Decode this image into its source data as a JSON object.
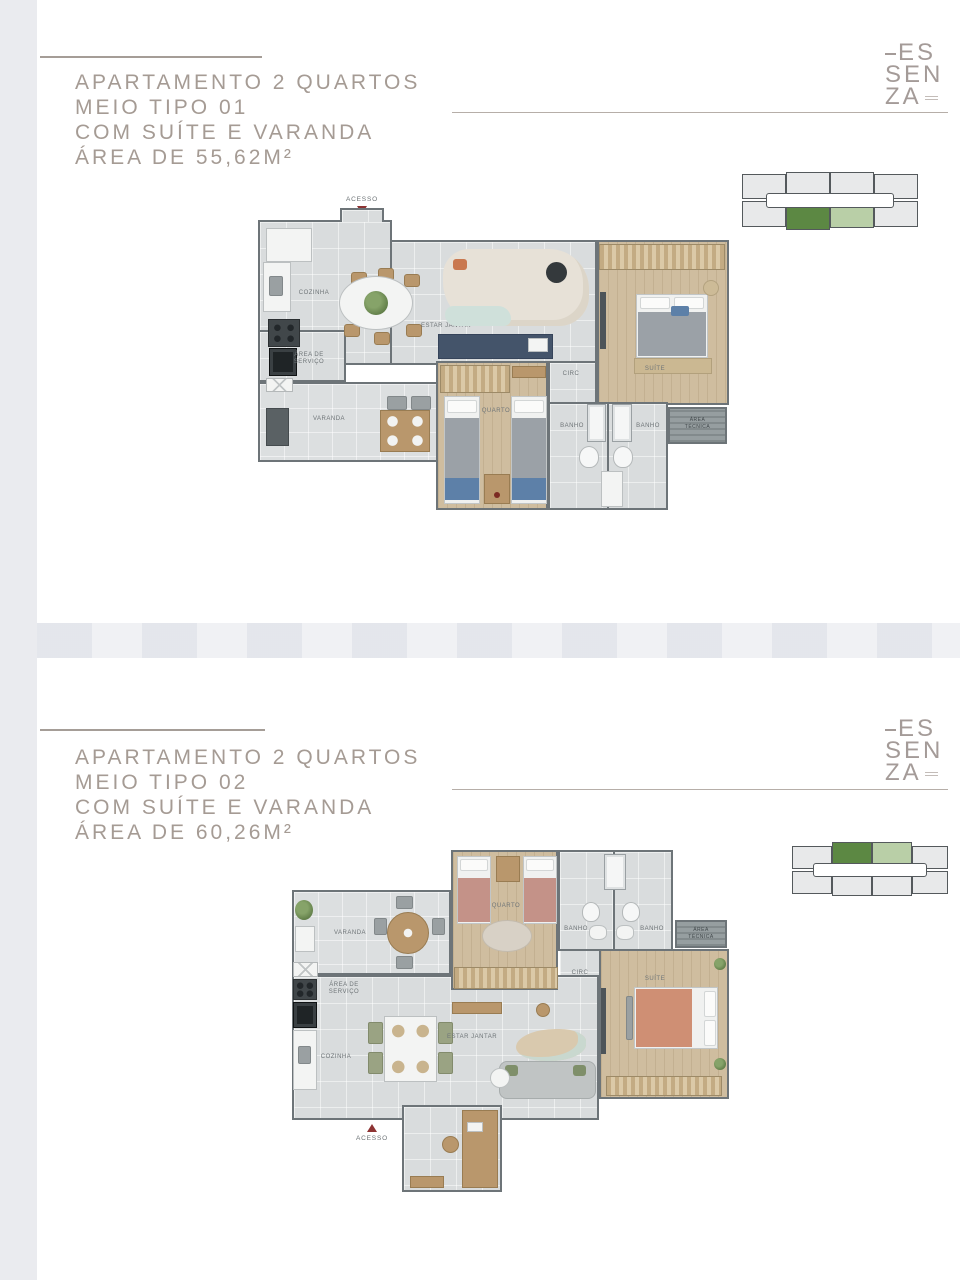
{
  "colors": {
    "page_bg": "#ffffff",
    "side_strip": "#eaebef",
    "title_text": "#a59b94",
    "rule": "#a59d97",
    "logo_text": "#a49b98",
    "key_dark_green": "#5c8843",
    "key_light_green": "#b9cfa7",
    "key_unit_gray": "#e8e9ea",
    "key_outline": "#54595c",
    "accent_red": "#8d3333"
  },
  "logo": {
    "line1": "ES",
    "line2": "SEN",
    "line3": "ZA"
  },
  "sections": [
    {
      "title1": "APARTAMENTO 2 QUARTOS",
      "title2": "MEIO TIPO 01",
      "title3": "COM SUÍTE E VARANDA",
      "title4": "ÁREA DE 55,62M²",
      "key_highlight_row": "bottom",
      "labels": {
        "acesso": "ACESSO",
        "cozinha": "COZINHA",
        "area_servico1": "ÁREA DE",
        "area_servico2": "SERVIÇO",
        "varanda": "VARANDA",
        "estar_jantar": "ESTAR JANTAR",
        "quarto": "QUARTO",
        "banho1": "BANHO",
        "banho2": "BANHO",
        "circ": "CIRC",
        "suite": "SUÍTE",
        "area_tecnica1": "ÁREA",
        "area_tecnica2": "TÉCNICA"
      }
    },
    {
      "title1": "APARTAMENTO 2 QUARTOS",
      "title2": "MEIO TIPO 02",
      "title3": "COM SUÍTE E VARANDA",
      "title4": "ÁREA DE 60,26M²",
      "key_highlight_row": "top",
      "labels": {
        "acesso": "ACESSO",
        "cozinha": "COZINHA",
        "area_servico1": "ÁREA DE",
        "area_servico2": "SERVIÇO",
        "varanda": "VARANDA",
        "estar_jantar": "ESTAR JANTAR",
        "quarto": "QUARTO",
        "banho1": "BANHO",
        "banho2": "BANHO",
        "circ": "CIRC",
        "suite": "SUÍTE",
        "area_tecnica1": "ÁREA",
        "area_tecnica2": "TÉCNICA"
      }
    }
  ]
}
